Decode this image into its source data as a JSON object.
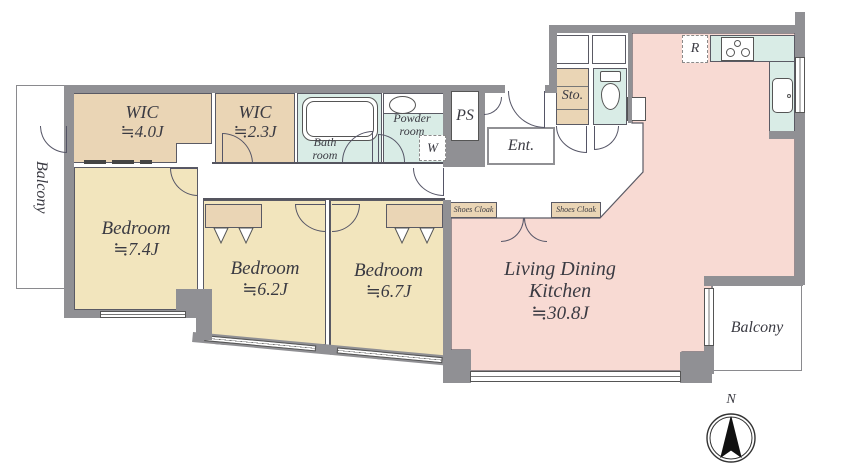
{
  "plan": {
    "balcony_left": {
      "label": "Balcony"
    },
    "wic_4": {
      "name": "WIC",
      "size": "≒4.0J"
    },
    "wic_2": {
      "name": "WIC",
      "size": "≒2.3J"
    },
    "bathroom": {
      "line1": "Bath",
      "line2": "room"
    },
    "powder_room": {
      "line1": "Powder",
      "line2": "room"
    },
    "washer": {
      "label": "W"
    },
    "pipe_space": {
      "label": "PS"
    },
    "entrance": {
      "label": "Ent."
    },
    "storage": {
      "label": "Sto."
    },
    "refrigerator": {
      "label": "R"
    },
    "shoes_cloak_left": {
      "label": "Shoes Cloak"
    },
    "shoes_cloak_right": {
      "label": "Shoes Cloak"
    },
    "bedroom_1": {
      "name": "Bedroom",
      "size": "≒7.4J"
    },
    "bedroom_2": {
      "name": "Bedroom",
      "size": "≒6.2J"
    },
    "bedroom_3": {
      "name": "Bedroom",
      "size": "≒6.7J"
    },
    "ldk": {
      "line1": "Living Dining",
      "line2": "Kitchen",
      "size": "≒30.8J"
    },
    "balcony_right": {
      "label": "Balcony"
    },
    "compass": {
      "label": "N"
    }
  },
  "colors": {
    "wall": "#909094",
    "room_tan": "#ead5b5",
    "room_yellow": "#f2e5bd",
    "room_pink": "#f8dad3",
    "room_teal": "#d9ece6",
    "line": "#55555f",
    "text": "#3a3a42"
  }
}
